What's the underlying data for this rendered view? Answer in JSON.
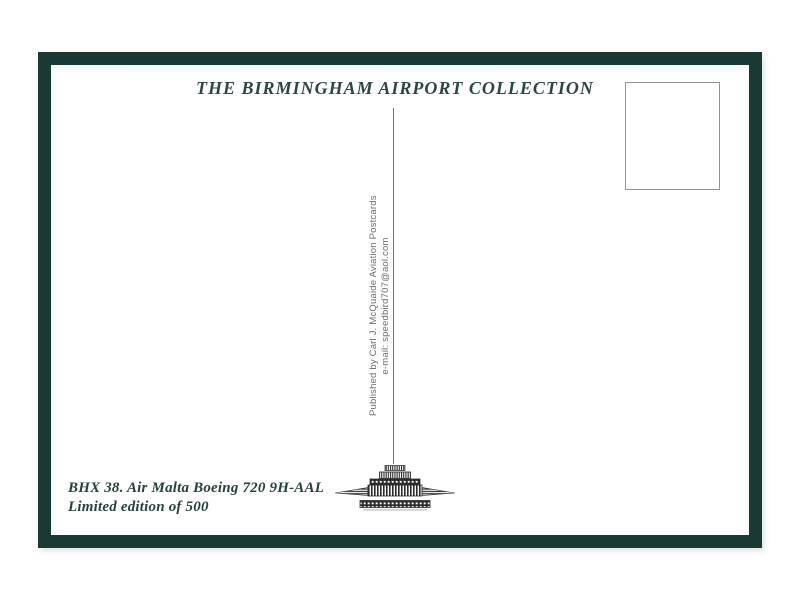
{
  "postcard": {
    "title": "THE BIRMINGHAM AIRPORT COLLECTION",
    "publisher": {
      "line1": "Published by Carl J. McQuaide Aviation Postcards",
      "line2": "e-mail: speedbird707@aol.com"
    },
    "caption": {
      "line1": "BHX 38. Air Malta Boeing 720 9H-AAL",
      "line2": "Limited edition of 500"
    },
    "stamp_box_content": "",
    "logo": "birmingham-airport-terminal-building",
    "colors": {
      "border_green": "#1b3934",
      "title_ink": "#2c4746",
      "caption_ink": "#24423e",
      "publisher_ink": "#6b6b6b",
      "divider_gray": "#6e6e6e",
      "stamp_border": "#949494",
      "logo_ink": "#2b2b2b",
      "card_bg": "#ffffff",
      "page_bg": "#ffffff"
    }
  }
}
